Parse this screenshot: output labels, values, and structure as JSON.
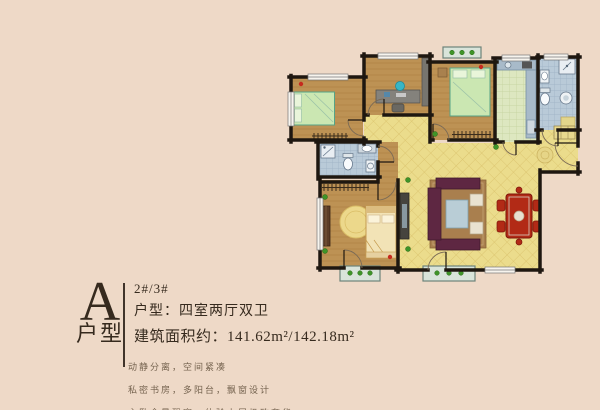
{
  "page": {
    "background_color": "#eed9c7"
  },
  "unit_info": {
    "type_letter": "A",
    "type_label": "户型",
    "block_numbers": "2#/3#",
    "layout_line": "户型：四室两厅双卫",
    "area_line": "建筑面积约：141.62m²/142.18m²"
  },
  "features": [
    "动静分离，空间紧凑",
    "私密书房，多阳台，飘窗设计",
    "主卧全景飘窗，体验上层极致奢华"
  ],
  "floorplan": {
    "rooms": [
      "bedroom",
      "study",
      "bedroom",
      "kitchen",
      "bathroom",
      "bathroom",
      "master-bedroom",
      "living-dining-room",
      "entry-hall",
      "balcony",
      "balcony",
      "balcony"
    ],
    "colors": {
      "wall": "#1e1710",
      "wood_floor": "#bd9254",
      "hall_floor": "#ebdc8c",
      "kitchen_floor": "#dde7c0",
      "bath_floor": "#b9cad8",
      "balcony_floor": "#d9e4da",
      "plant_green": "#3f9428",
      "bed_green": "#cbe7b2",
      "bed_cream": "#f2e3b6",
      "sofa_maroon": "#5e2742",
      "dining_red": "#b22a16",
      "alarm_red": "#c62a1e",
      "text_brown": "#362a1e"
    }
  }
}
